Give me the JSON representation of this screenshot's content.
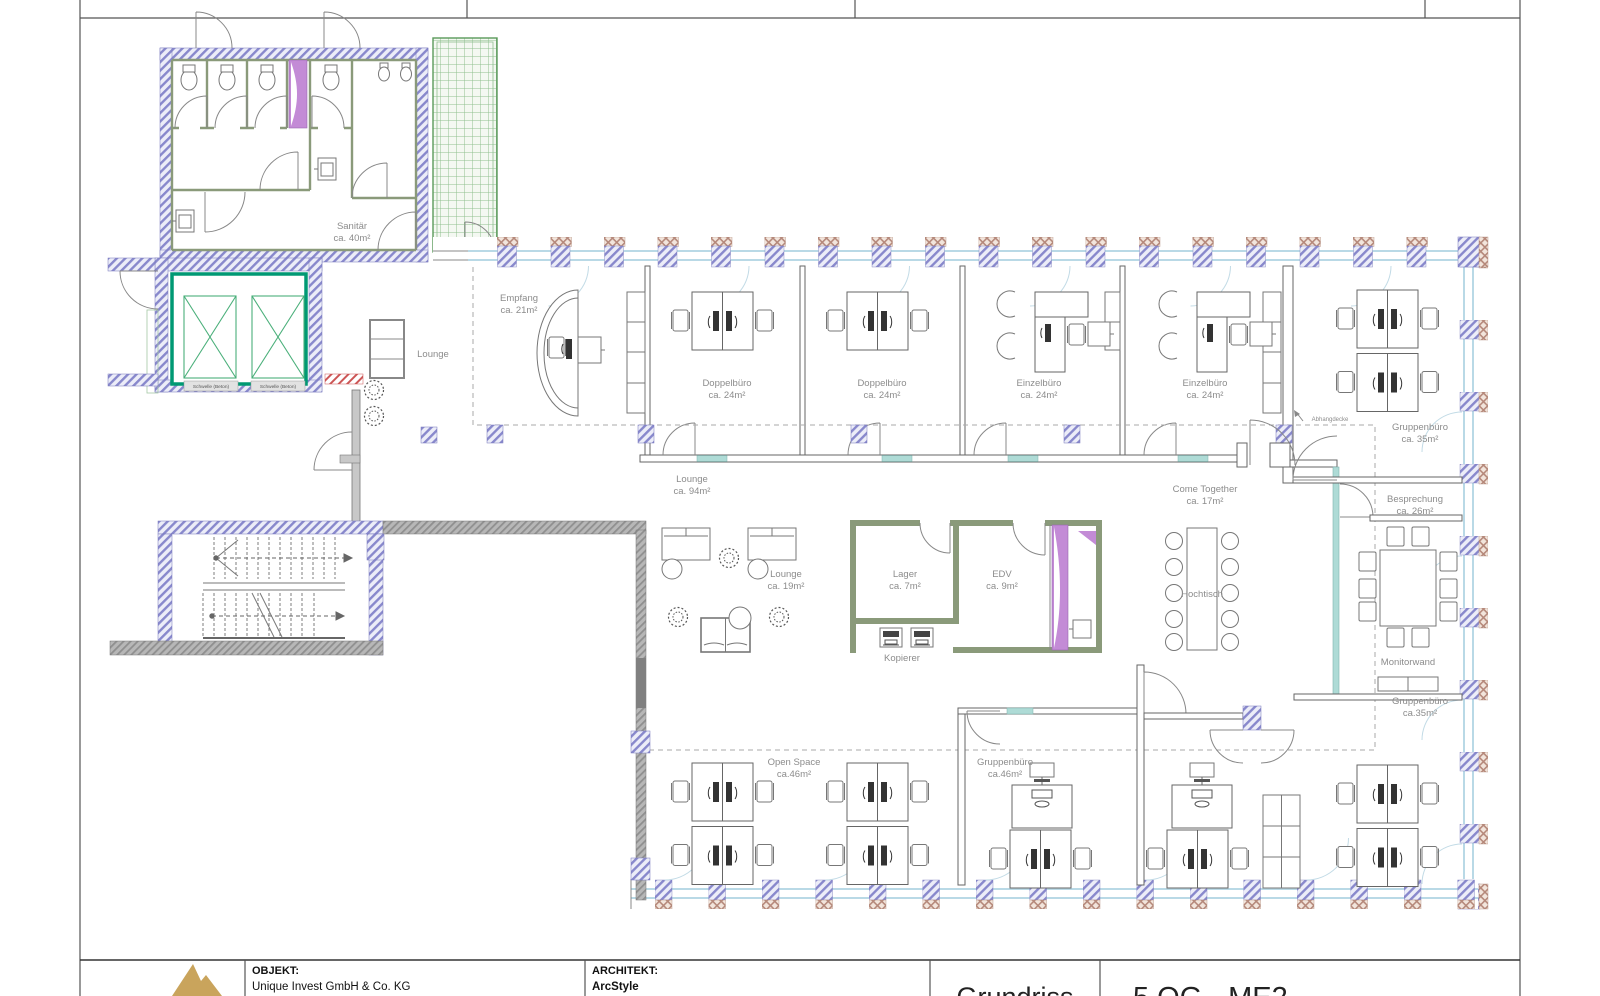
{
  "title_block": {
    "objekt_label": "OBJEKT:",
    "objekt_value": "Unique Invest GmbH & Co. KG",
    "architekt_label": "ARCHITEKT:",
    "architekt_value": "ArcStyle",
    "drawing_title": "Grundriss",
    "drawing_code": "5.OG - ME2"
  },
  "rooms": {
    "sanitaer": {
      "name": "Sanitär",
      "area": "ca. 40m²"
    },
    "lounge_small": {
      "name": "Lounge"
    },
    "empfang": {
      "name": "Empfang",
      "area": "ca. 21m²"
    },
    "doppelbuero_1": {
      "name": "Doppelbüro",
      "area": "ca. 24m²"
    },
    "doppelbuero_2": {
      "name": "Doppelbüro",
      "area": "ca. 24m²"
    },
    "einzelbuero_1": {
      "name": "Einzelbüro",
      "area": "ca. 24m²"
    },
    "einzelbuero_2": {
      "name": "Einzelbüro",
      "area": "ca. 24m²"
    },
    "gruppenbuero_top": {
      "name": "Gruppenbüro",
      "area": "ca. 35m²"
    },
    "lounge_94": {
      "name": "Lounge",
      "area": "ca. 94m²"
    },
    "lounge_19": {
      "name": "Lounge",
      "area": "ca. 19m²"
    },
    "lager": {
      "name": "Lager",
      "area": "ca. 7m²"
    },
    "edv": {
      "name": "EDV",
      "area": "ca. 9m²"
    },
    "come_together": {
      "name": "Come Together",
      "area": "ca. 17m²"
    },
    "besprechung": {
      "name": "Besprechung",
      "area": "ca. 26m²"
    },
    "gruppenbuero_right": {
      "name": "Gruppenbüro",
      "area": "ca.35m²"
    },
    "open_space": {
      "name": "Open Space",
      "area": "ca.46m²"
    },
    "gruppenbuero_bottom": {
      "name": "Gruppenbüro",
      "area": "ca.46m²"
    }
  },
  "annotations": {
    "hochtisch": "Hochtisch",
    "kopierer": "Kopierer",
    "monitorwand": "Monitorwand",
    "abhangdecke": "Abhangdecke",
    "schwelle_beton": "Schwelle (Beton)"
  },
  "colors": {
    "wall_hatch_blue": "#8888cc",
    "wall_hatch_bg": "#ecedf8",
    "pier_brown": "#b5887a",
    "partition_olive": "#8a9a7a",
    "elevator_green": "#009973",
    "atrium_green": "#8fbf8f",
    "shaft_purple": "#c38bd6",
    "window_blue": "#b9d9e6",
    "door_sill_teal": "#aedbd6",
    "accent_red": "#cc5555",
    "text_gray": "#8c8c8c",
    "logo_gold": "#c9a45c"
  }
}
